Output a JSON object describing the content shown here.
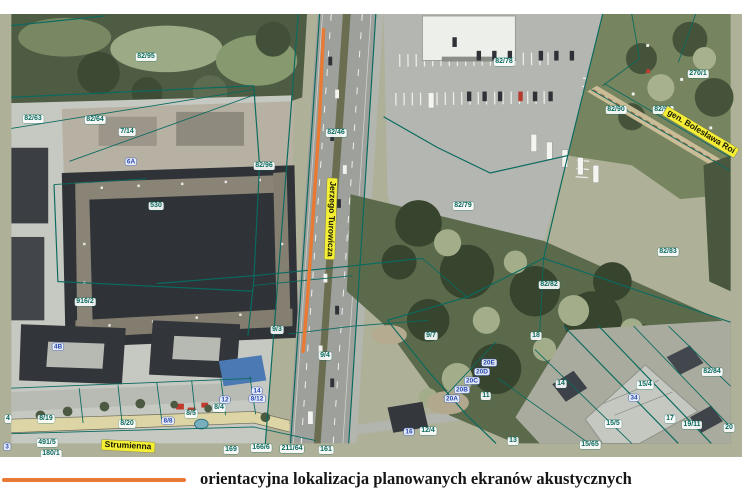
{
  "caption": {
    "text": "orientacyjna lokalizacja planowanych ekranów akustycznych"
  },
  "map": {
    "colors": {
      "accent": "#e87a33",
      "teal": "#0a6a5f",
      "street-bg": "#f4ef35"
    },
    "street_names": [
      "Strumienna",
      "Jerzego Turowicza",
      "gen. Bolesława Roi"
    ],
    "labels": [
      {
        "text": "82/95",
        "type": "parcel",
        "x": 146,
        "y": 57
      },
      {
        "text": "82/63",
        "type": "parcel",
        "x": 33,
        "y": 119
      },
      {
        "text": "82/64",
        "type": "parcel",
        "x": 95,
        "y": 120
      },
      {
        "text": "7/14",
        "type": "parcel",
        "x": 127,
        "y": 132
      },
      {
        "text": "82/46",
        "type": "parcel",
        "x": 336,
        "y": 133
      },
      {
        "text": "82/78",
        "type": "parcel",
        "x": 504,
        "y": 62
      },
      {
        "text": "270/1",
        "type": "parcel",
        "x": 698,
        "y": 74
      },
      {
        "text": "82/90",
        "type": "parcel",
        "x": 616,
        "y": 110
      },
      {
        "text": "82/91",
        "type": "parcel",
        "x": 663,
        "y": 110
      },
      {
        "text": "82/96",
        "type": "parcel",
        "x": 264,
        "y": 166
      },
      {
        "text": "530",
        "type": "parcel",
        "x": 156,
        "y": 206
      },
      {
        "text": "82/79",
        "type": "parcel",
        "x": 463,
        "y": 206
      },
      {
        "text": "916/2",
        "type": "parcel",
        "x": 85,
        "y": 302
      },
      {
        "text": "82/82",
        "type": "parcel",
        "x": 549,
        "y": 285
      },
      {
        "text": "82/83",
        "type": "parcel",
        "x": 668,
        "y": 252
      },
      {
        "text": "9/3",
        "type": "parcel",
        "x": 277,
        "y": 330
      },
      {
        "text": "9/4",
        "type": "parcel",
        "x": 325,
        "y": 356
      },
      {
        "text": "9/7",
        "type": "parcel",
        "x": 431,
        "y": 336
      },
      {
        "text": "8/19",
        "type": "parcel",
        "x": 46,
        "y": 419
      },
      {
        "text": "8/20",
        "type": "parcel",
        "x": 127,
        "y": 424
      },
      {
        "text": "8/5",
        "type": "parcel",
        "x": 191,
        "y": 414
      },
      {
        "text": "8/4",
        "type": "parcel",
        "x": 219,
        "y": 408
      },
      {
        "text": "491/5",
        "type": "parcel",
        "x": 47,
        "y": 443
      },
      {
        "text": "180/1",
        "type": "parcel",
        "x": 51,
        "y": 454
      },
      {
        "text": "169",
        "type": "parcel",
        "x": 231,
        "y": 450
      },
      {
        "text": "166/6",
        "type": "parcel",
        "x": 261,
        "y": 448
      },
      {
        "text": "211/64",
        "type": "parcel",
        "x": 292,
        "y": 449
      },
      {
        "text": "161",
        "type": "parcel",
        "x": 326,
        "y": 450
      },
      {
        "text": "12/4",
        "type": "parcel",
        "x": 428,
        "y": 431
      },
      {
        "text": "18",
        "type": "parcel",
        "x": 536,
        "y": 336
      },
      {
        "text": "14",
        "type": "parcel",
        "x": 561,
        "y": 384
      },
      {
        "text": "15/4",
        "type": "parcel",
        "x": 645,
        "y": 385
      },
      {
        "text": "17",
        "type": "parcel",
        "x": 670,
        "y": 419
      },
      {
        "text": "82/84",
        "type": "parcel",
        "x": 712,
        "y": 372
      },
      {
        "text": "19/11",
        "type": "parcel",
        "x": 692,
        "y": 425
      },
      {
        "text": "20",
        "type": "parcel",
        "x": 729,
        "y": 428
      },
      {
        "text": "15/5",
        "type": "parcel",
        "x": 613,
        "y": 424
      },
      {
        "text": "15/65",
        "type": "parcel",
        "x": 590,
        "y": 445
      },
      {
        "text": "13",
        "type": "parcel",
        "x": 513,
        "y": 441
      },
      {
        "text": "11",
        "type": "parcel",
        "x": 486,
        "y": 396
      },
      {
        "text": "4",
        "type": "parcel",
        "x": 8,
        "y": 419
      },
      {
        "text": "6A",
        "type": "address",
        "x": 131,
        "y": 162
      },
      {
        "text": "4B",
        "type": "address",
        "x": 58,
        "y": 347
      },
      {
        "text": "14",
        "type": "address",
        "x": 257,
        "y": 391
      },
      {
        "text": "8/12",
        "type": "address",
        "x": 257,
        "y": 399
      },
      {
        "text": "12",
        "type": "address",
        "x": 225,
        "y": 400
      },
      {
        "text": "8/8",
        "type": "address",
        "x": 168,
        "y": 421
      },
      {
        "text": "16",
        "type": "address",
        "x": 409,
        "y": 432
      },
      {
        "text": "20E",
        "type": "address",
        "x": 489,
        "y": 363
      },
      {
        "text": "20D",
        "type": "address",
        "x": 482,
        "y": 372
      },
      {
        "text": "20C",
        "type": "address",
        "x": 472,
        "y": 381
      },
      {
        "text": "20B",
        "type": "address",
        "x": 462,
        "y": 390
      },
      {
        "text": "20A",
        "type": "address",
        "x": 452,
        "y": 399
      },
      {
        "text": "34",
        "type": "address",
        "x": 634,
        "y": 398
      },
      {
        "text": "3",
        "type": "address",
        "x": 7,
        "y": 447
      },
      {
        "text": "Strumienna",
        "type": "street",
        "x": 128,
        "y": 446,
        "rot": 3
      },
      {
        "text": "Jerzego Turowicza",
        "type": "street",
        "x": 331,
        "y": 219,
        "rot": 92
      },
      {
        "text": "gen. Bolesława Roi",
        "type": "street",
        "x": 701,
        "y": 132,
        "rot": 31
      }
    ]
  }
}
